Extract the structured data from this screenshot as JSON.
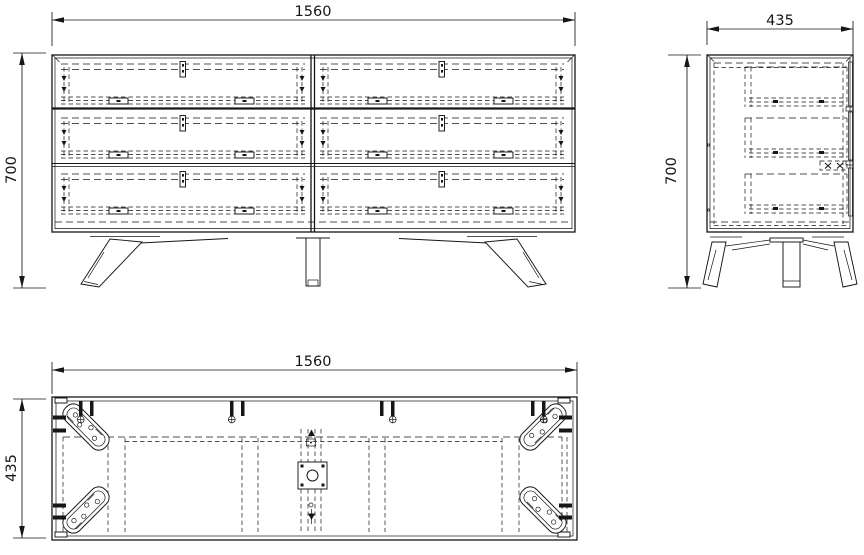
{
  "document": {
    "kind": "furniture-orthographic-drawing",
    "colors": {
      "background": "#ffffff",
      "line": "#161616"
    }
  },
  "views": {
    "front_view": {
      "width_mm": "1560",
      "height_mm": "700"
    },
    "side_view": {
      "width_mm": "435",
      "height_mm": "700"
    },
    "top_view": {
      "width_mm": "1560",
      "depth_mm": "435"
    }
  }
}
